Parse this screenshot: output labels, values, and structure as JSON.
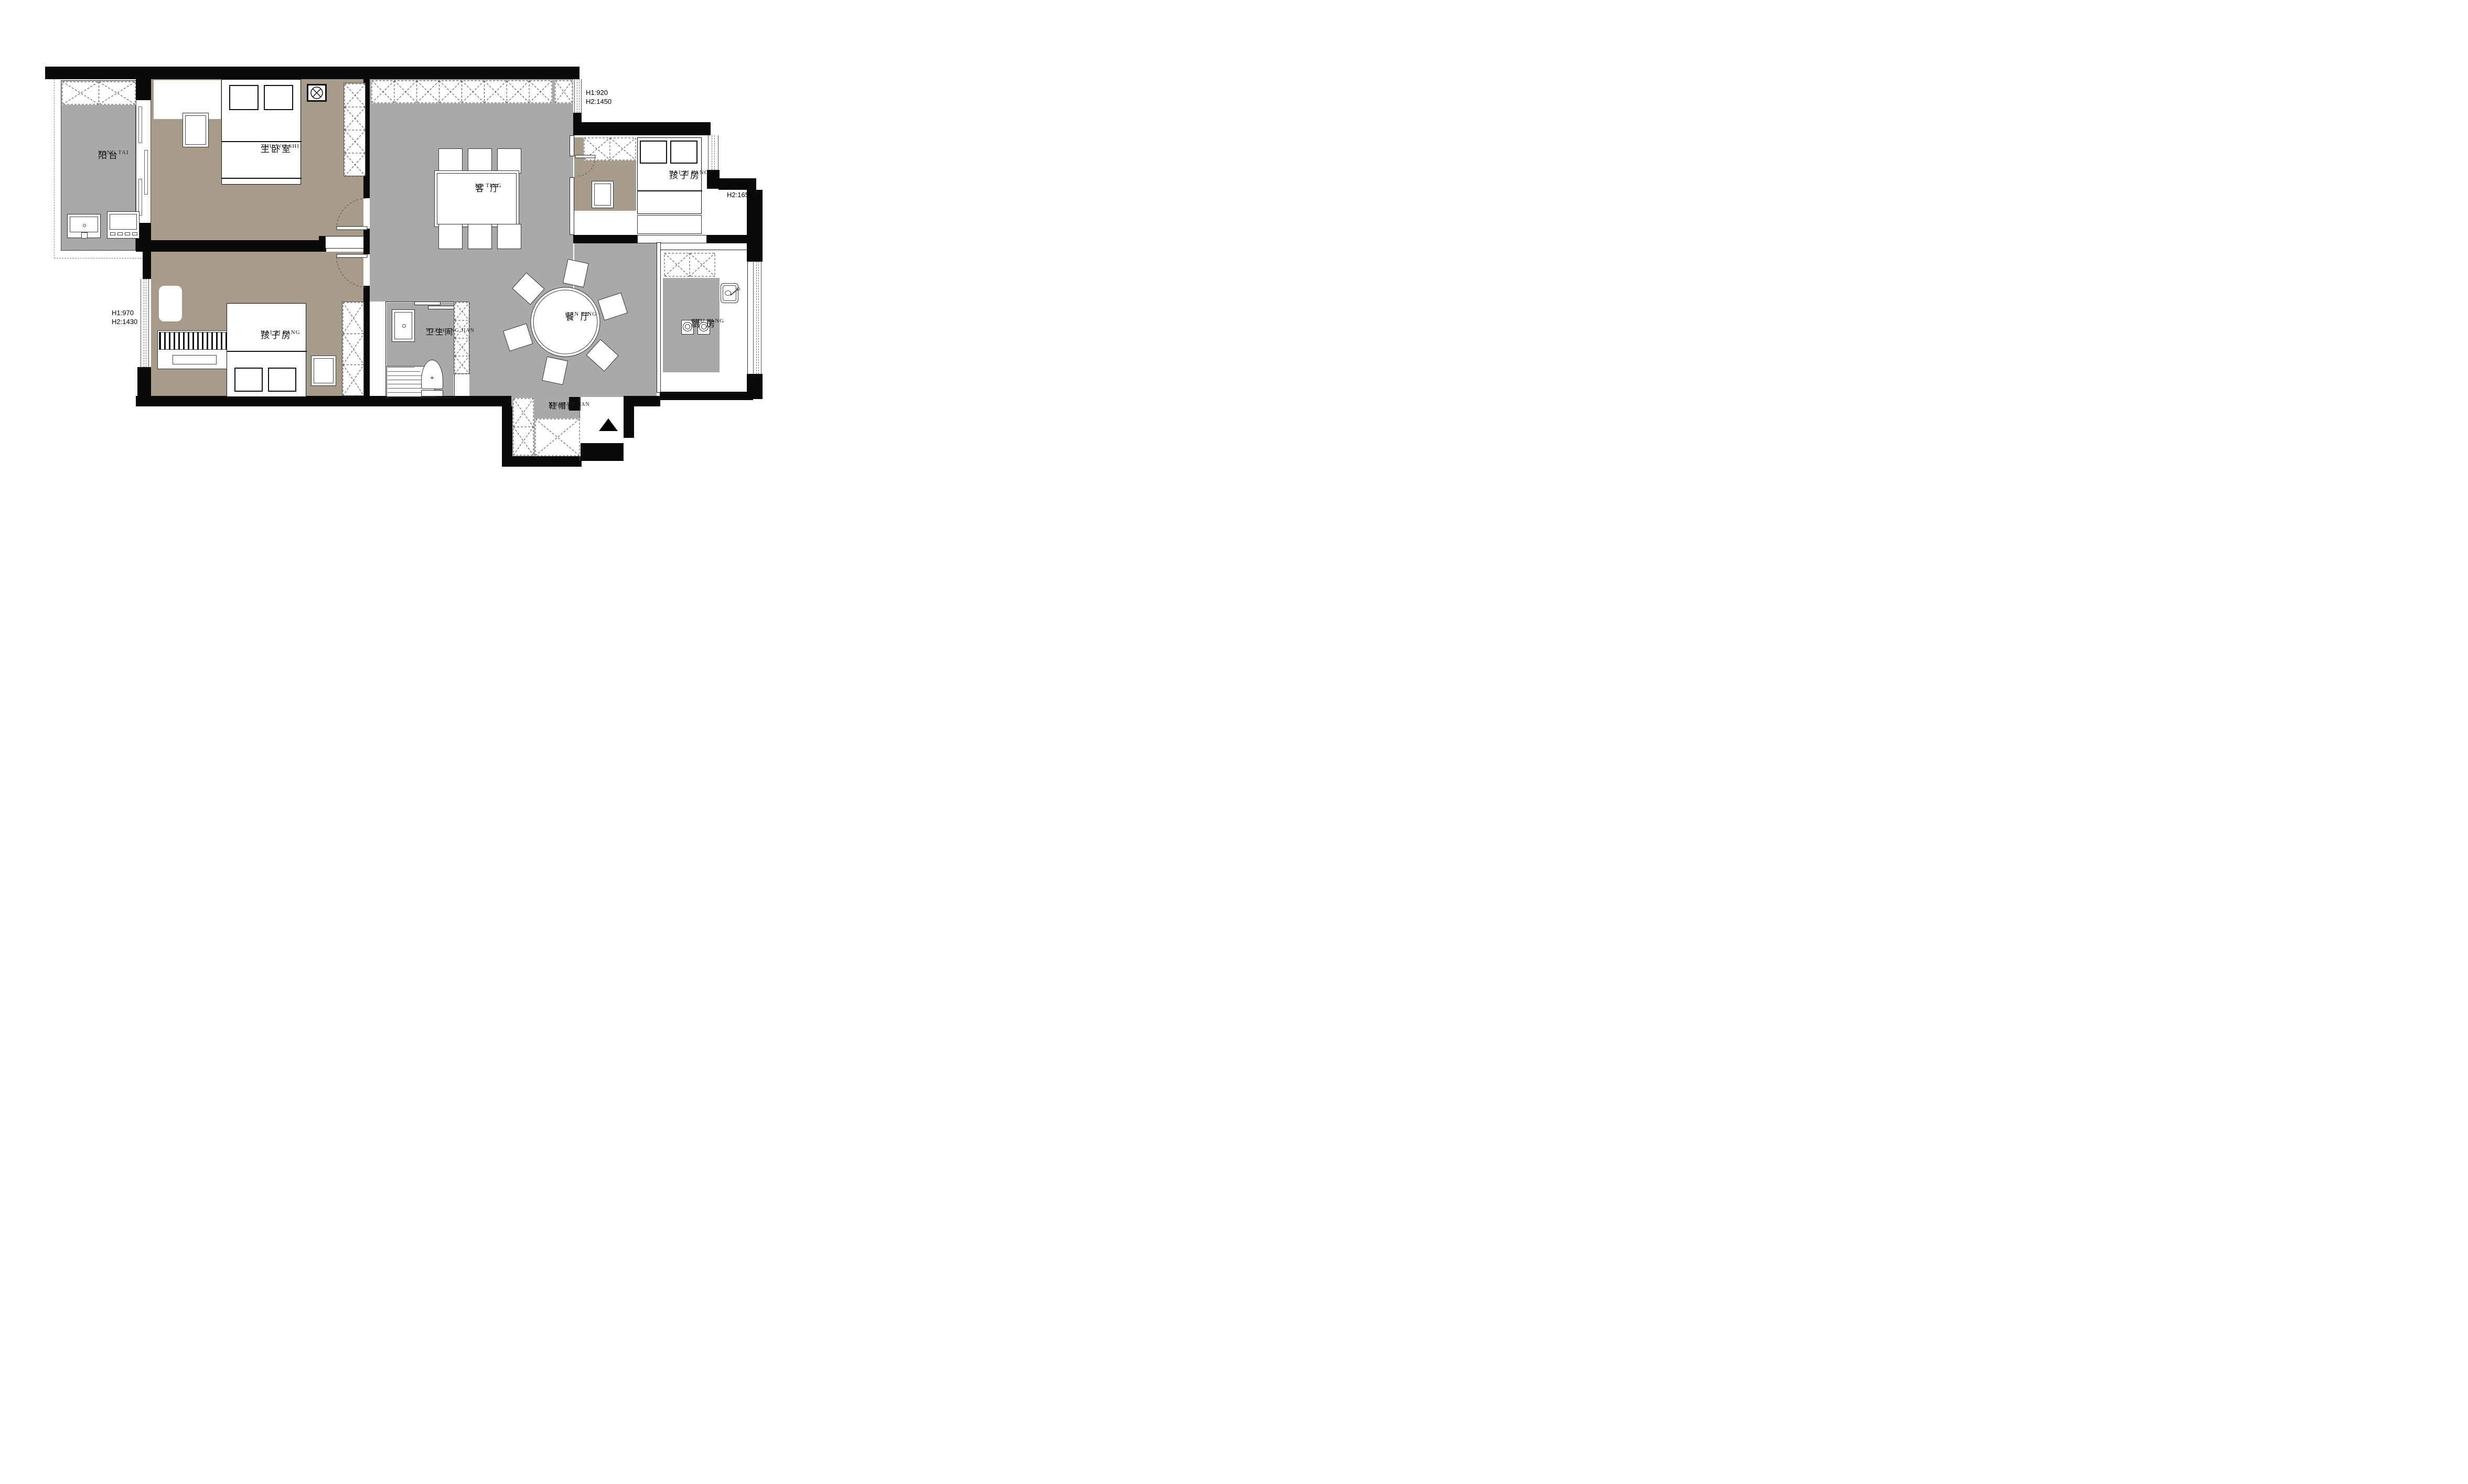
{
  "plan": {
    "rooms": {
      "balcony": {
        "label": "阳台",
        "pinyin": "YANG TAI"
      },
      "master": {
        "label": "主卧室",
        "pinyin": "ZHU WO SHI"
      },
      "living": {
        "label": "客 厅",
        "pinyin": "KE TING"
      },
      "child_right": {
        "label": "孩子房",
        "pinyin": "HAI ZI FANG"
      },
      "child_left": {
        "label": "孩子房",
        "pinyin": "HAI ZI FANG"
      },
      "bathroom": {
        "label": "卫生间",
        "pinyin": "WEI SHENG JIAN"
      },
      "dining": {
        "label": "餐 厅",
        "pinyin": "CAN TING"
      },
      "kitchen": {
        "label": "厨 房",
        "pinyin": "CHU FANG"
      },
      "cloakroom": {
        "label": "鞋帽间",
        "pinyin": "XIE MAO JIAN"
      }
    },
    "annotations": {
      "window_top_right": {
        "line1": "H1:920",
        "line2": "H2:1450"
      },
      "window_right": {
        "line1": "H1:935",
        "line2": "H2:1655"
      },
      "window_left": {
        "line1": "H1:970",
        "line2": "H2:1430"
      }
    },
    "colors": {
      "wall": "#0a0a0a",
      "floor_gray": "#a9a9a9",
      "floor_taupe": "#a79c8c"
    }
  }
}
